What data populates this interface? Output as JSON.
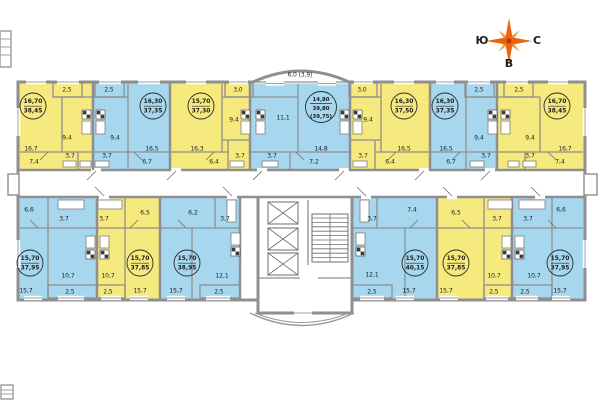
{
  "compass": {
    "south": "Ю",
    "north": "С",
    "east": "В"
  },
  "colors": {
    "apartment_yellow": "#f6e97e",
    "apartment_blue": "#a6d7ef",
    "wall_gray": "#8f8f8f",
    "compass_orange": "#e8650f",
    "compass_inner": "#f59b3c"
  },
  "apartments": [
    {
      "id": "top-1",
      "color": "yellow",
      "summary": {
        "line1": "16,70",
        "line2": "38,45"
      },
      "areas": {
        "main": "16,7",
        "kitchen": "9,4",
        "hall": "7,4",
        "bath": "3,7",
        "balcony": "2,5"
      }
    },
    {
      "id": "top-2",
      "color": "blue",
      "summary": {
        "line1": "16,30",
        "line2": "37,35"
      },
      "areas": {
        "main": "16,5",
        "kitchen": "9,4",
        "hall": "6,7",
        "bath": "3,7",
        "balcony": "2,5"
      }
    },
    {
      "id": "top-3",
      "color": "yellow",
      "summary": {
        "line1": "15,70",
        "line2": "37,30"
      },
      "areas": {
        "main": "16,3",
        "kitchen": "9,4",
        "hall": "6,4",
        "bath": "3,7",
        "balcony": "3,0"
      }
    },
    {
      "id": "top-4",
      "color": "blue",
      "summary": {
        "line1": "14,80",
        "line2": "39,80",
        "line3": "(39,75)"
      },
      "areas": {
        "main": "14,8",
        "second_room": "11,1",
        "hall": "7,2",
        "bath": "3,7",
        "balcony": "6,0 (3,9)"
      }
    },
    {
      "id": "top-5",
      "color": "yellow",
      "summary": {
        "line1": "16,30",
        "line2": "37,50"
      },
      "areas": {
        "main": "16,5",
        "kitchen": "9,4",
        "hall": "6,4",
        "bath": "3,7",
        "balcony": "3,0"
      }
    },
    {
      "id": "top-6",
      "color": "blue",
      "summary": {
        "line1": "16,30",
        "line2": "37,35"
      },
      "areas": {
        "main": "16,5",
        "kitchen": "9,4",
        "hall": "6,7",
        "bath": "3,7",
        "balcony": "2,5"
      }
    },
    {
      "id": "top-7",
      "color": "yellow",
      "summary": {
        "line1": "16,70",
        "line2": "38,45"
      },
      "areas": {
        "main": "16,7",
        "kitchen": "9,4",
        "hall": "7,4",
        "bath": "3,7",
        "balcony": "2,5"
      }
    },
    {
      "id": "bottom-1",
      "color": "blue",
      "summary": {
        "line1": "15,70",
        "line2": "37,95"
      },
      "areas": {
        "main": "15,7",
        "kitchen": "10,7",
        "hall": "6,6",
        "bath": "3,7",
        "balcony": "2,5"
      }
    },
    {
      "id": "bottom-2",
      "color": "yellow",
      "summary": {
        "line1": "15,70",
        "line2": "37,85"
      },
      "areas": {
        "main": "15,7",
        "kitchen": "10,7",
        "hall": "6,5",
        "bath": "3,7",
        "balcony": "2,5"
      }
    },
    {
      "id": "bottom-3",
      "color": "blue",
      "summary": {
        "line1": "15,70",
        "line2": "38,95"
      },
      "areas": {
        "main": "15,7",
        "kitchen": "12,1",
        "hall": "6,2",
        "bath": "3,7",
        "balcony": "2,5"
      }
    },
    {
      "id": "bottom-4",
      "color": "blue",
      "summary": {
        "line1": "15,70",
        "line2": "40,15"
      },
      "areas": {
        "main": "15,7",
        "kitchen": "12,1",
        "hall": "7,4",
        "bath": "3,7",
        "balcony": "2,5"
      }
    },
    {
      "id": "bottom-5",
      "color": "yellow",
      "summary": {
        "line1": "15,70",
        "line2": "37,85"
      },
      "areas": {
        "main": "15,7",
        "kitchen": "10,7",
        "hall": "6,5",
        "bath": "3,7",
        "balcony": "2,5"
      }
    },
    {
      "id": "bottom-6",
      "color": "blue",
      "summary": {
        "line1": "15,70",
        "line2": "37,95"
      },
      "areas": {
        "main": "15,7",
        "kitchen": "10,7",
        "hall": "6,6",
        "bath": "3,7",
        "balcony": "2,5"
      }
    }
  ]
}
